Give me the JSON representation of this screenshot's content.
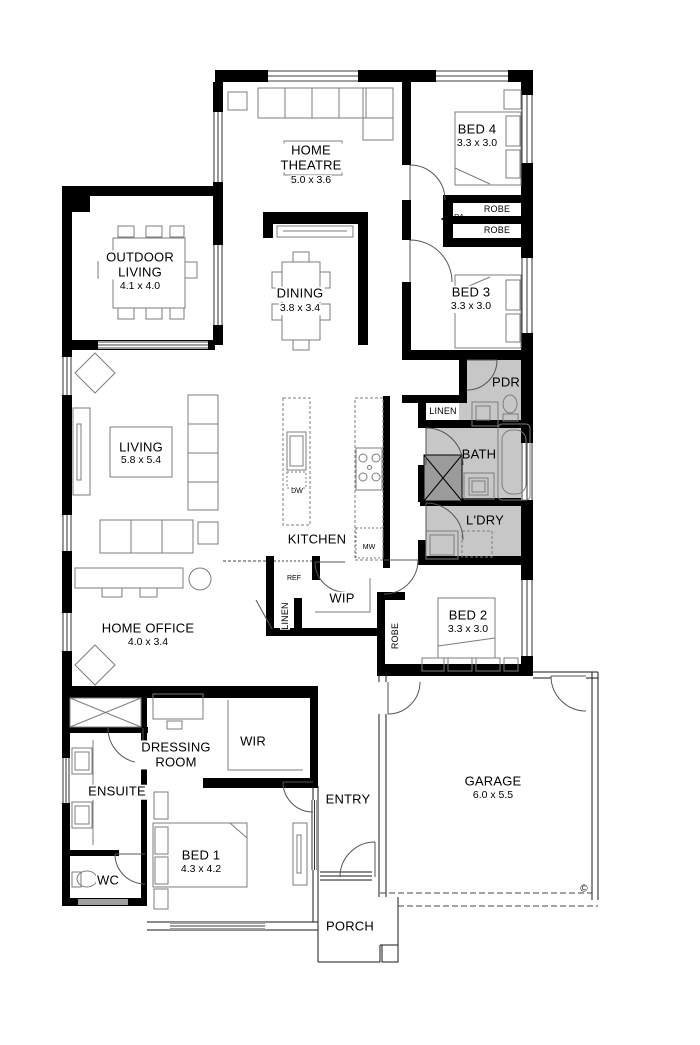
{
  "plan": {
    "rooms": {
      "home_theatre": {
        "name": "HOME THEATRE",
        "dims": "5.0 x 3.6"
      },
      "bed4": {
        "name": "BED 4",
        "dims": "3.3 x 3.0"
      },
      "outdoor_living": {
        "name": "OUTDOOR LIVING",
        "dims": "4.1 x 4.0"
      },
      "dining": {
        "name": "DINING",
        "dims": "3.8 x 3.4"
      },
      "bed3": {
        "name": "BED 3",
        "dims": "3.3 x 3.0"
      },
      "living": {
        "name": "LIVING",
        "dims": "5.8 x 5.4"
      },
      "kitchen": {
        "name": "KITCHEN"
      },
      "pdr": {
        "name": "PDR"
      },
      "bath": {
        "name": "BATH"
      },
      "ldry": {
        "name": "L'DRY"
      },
      "home_office": {
        "name": "HOME OFFICE",
        "dims": "4.0 x 3.4"
      },
      "wip": {
        "name": "WIP"
      },
      "bed2": {
        "name": "BED 2",
        "dims": "3.3 x 3.0"
      },
      "entry": {
        "name": "ENTRY"
      },
      "garage": {
        "name": "GARAGE",
        "dims": "6.0 x 5.5"
      },
      "dressing_room": {
        "name": "DRESSING ROOM"
      },
      "wir": {
        "name": "WIR"
      },
      "ensuite": {
        "name": "ENSUITE"
      },
      "wc": {
        "name": "WC"
      },
      "bed1": {
        "name": "BED 1",
        "dims": "4.3 x 4.2"
      },
      "porch": {
        "name": "PORCH"
      }
    },
    "storage": {
      "robe_top": "ROBE",
      "robe_bottom": "ROBE",
      "robe_bed2": "ROBE",
      "linen_bath": "LINEN",
      "linen_kitchen": "LINEN"
    },
    "appliances": {
      "ref": "REF",
      "mw": "MW",
      "dw": "DW",
      "ra": "RA"
    },
    "copyright": "©",
    "colors": {
      "wall": "#000000",
      "wet_area": "#c7c7c7",
      "furniture_line": "#7d7d7d"
    }
  }
}
